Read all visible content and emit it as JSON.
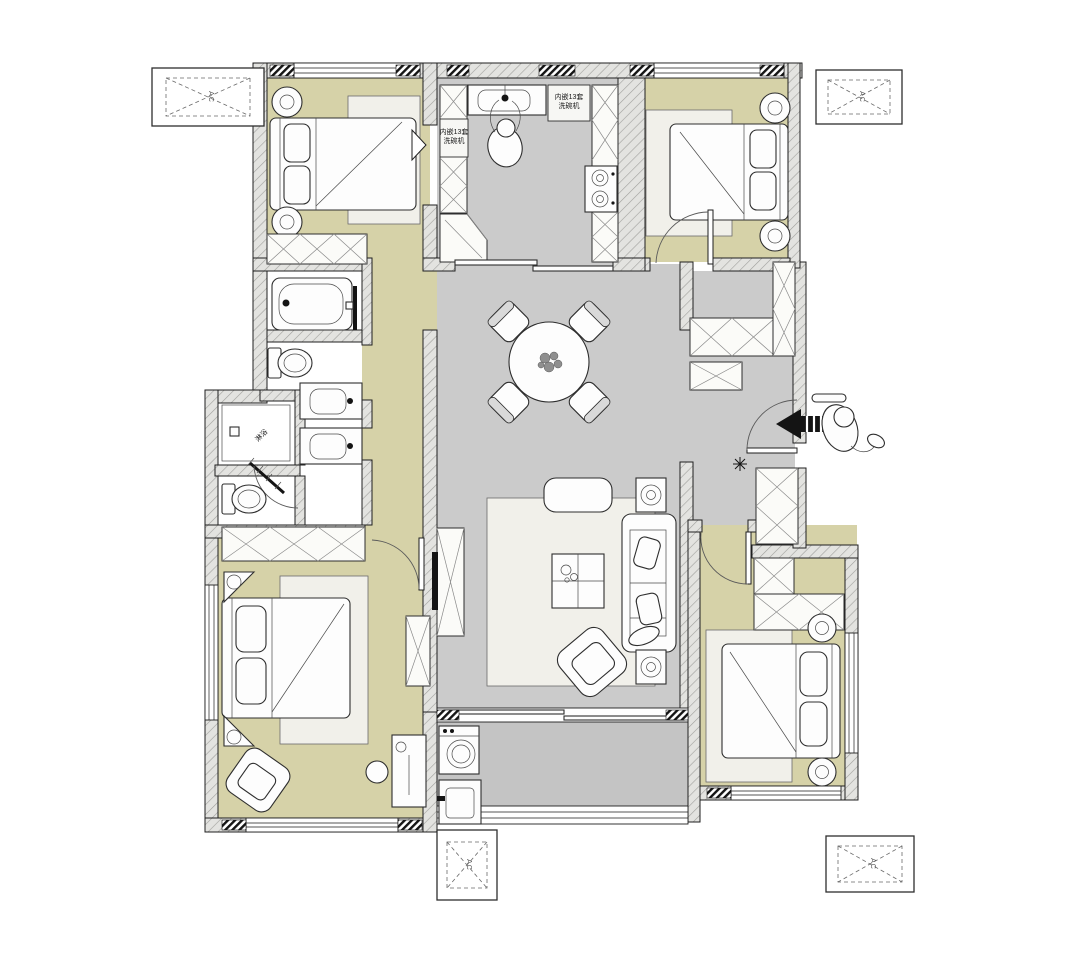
{
  "title": "apartment-floor-plan",
  "labels": {
    "ac": "AC",
    "dishwasher_line1": "内嵌13套",
    "dishwasher_line2": "洗碗机",
    "shower": "淋浴"
  },
  "colors": {
    "floor_beige": "#d6d2a8",
    "floor_gray": "#cbcbcb",
    "floor_gray_dark": "#c4c4c4",
    "floor_white": "#ffffff",
    "rug": "#f1f0ea",
    "wall_outline": "#1f1f1f",
    "arrow_black": "#141414"
  },
  "furniture_icons": [
    "double-bed-icon",
    "nightstand-icon",
    "wardrobe-icon",
    "dining-table-icon",
    "dining-chair-icon",
    "sofa-icon",
    "bench-icon",
    "coffee-table-icon",
    "armchair-icon",
    "tv-icon",
    "tv-cabinet-icon",
    "bathtub-icon",
    "toilet-icon",
    "sink-icon",
    "shower-icon",
    "washing-machine-icon",
    "laundry-sink-icon",
    "gas-stove-icon",
    "kitchen-sink-icon",
    "dishwasher-icon",
    "desk-icon",
    "stool-icon",
    "entry-arrow-icon",
    "person-icon",
    "wall-lamp-icon",
    "ac-platform-icon",
    "door-swing-icon",
    "sliding-door-icon"
  ]
}
